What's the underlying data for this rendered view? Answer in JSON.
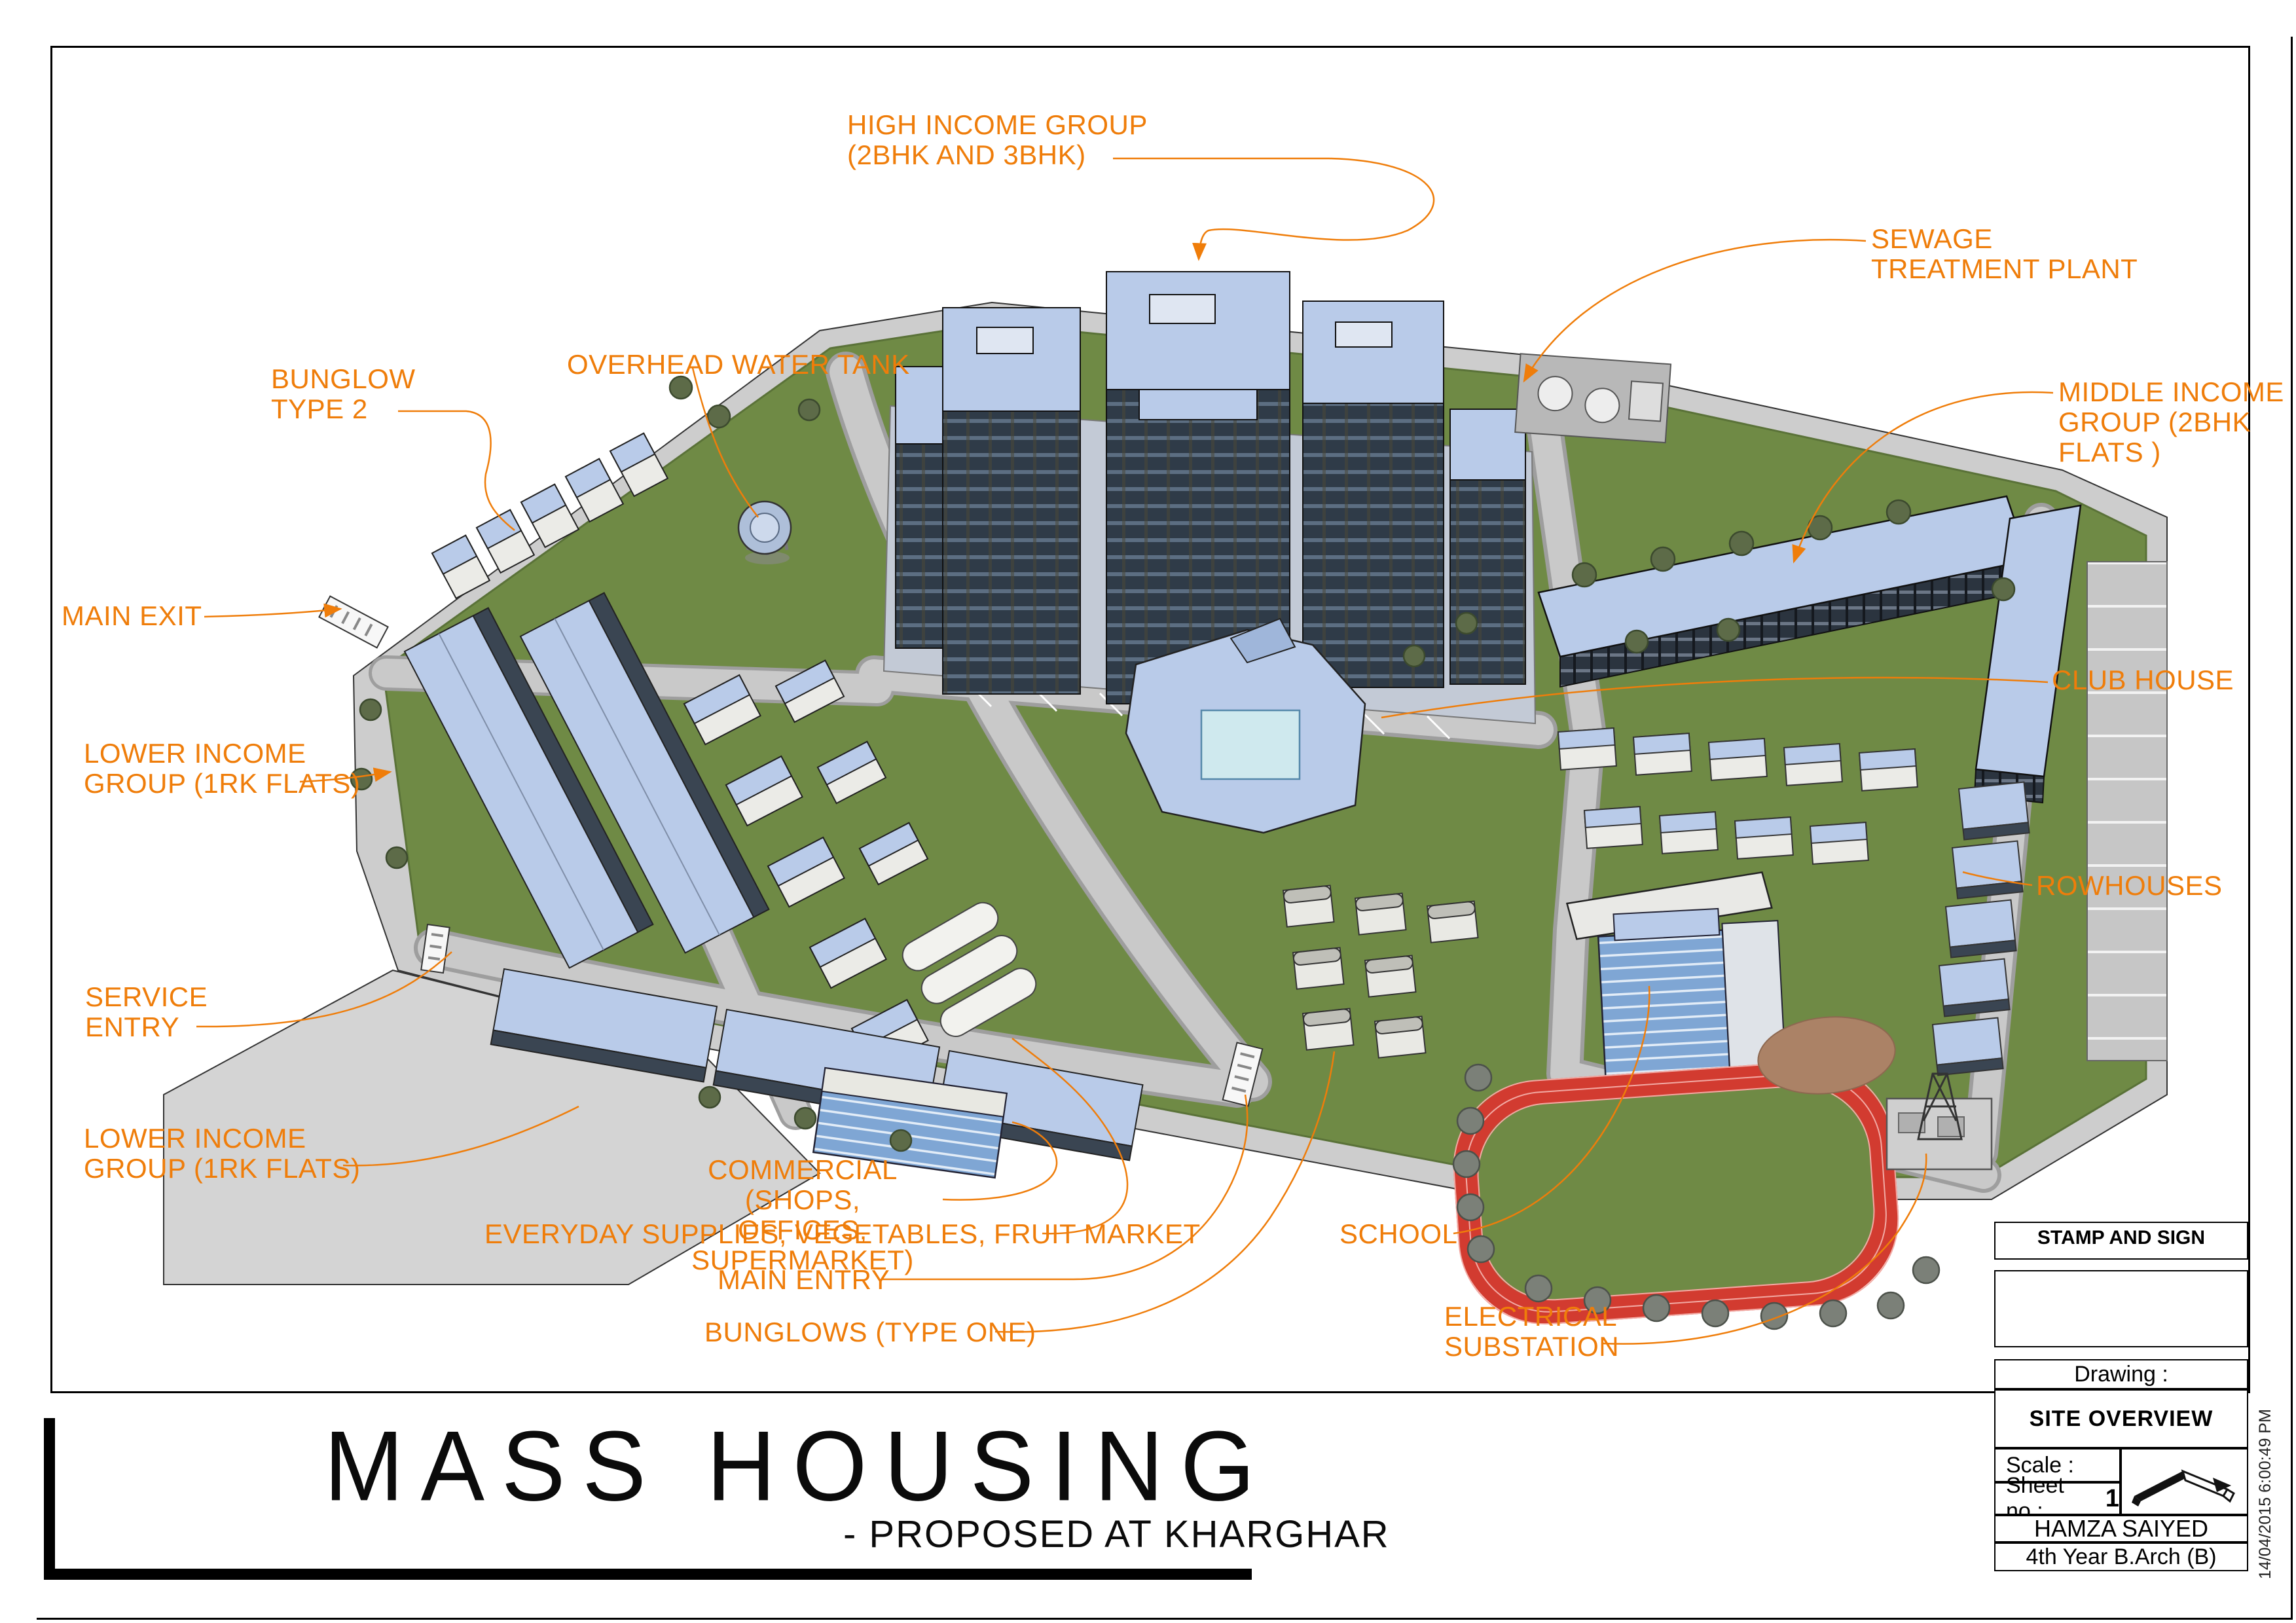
{
  "labels": {
    "high_income": {
      "lines": [
        "HIGH INCOME GROUP",
        "(2BHK AND 3BHK)"
      ]
    },
    "sewage": {
      "lines": [
        "SEWAGE",
        "TREATMENT PLANT"
      ]
    },
    "water_tank": {
      "lines": [
        "OVERHEAD WATER TANK"
      ]
    },
    "bunglow_type2": {
      "lines": [
        "BUNGLOW",
        "TYPE 2"
      ]
    },
    "middle_income": {
      "lines": [
        "MIDDLE INCOME",
        "GROUP (2BHK",
        "FLATS )"
      ]
    },
    "main_exit": {
      "lines": [
        "MAIN EXIT"
      ]
    },
    "lower_income_a": {
      "lines": [
        "LOWER INCOME",
        "GROUP (1RK FLATS)"
      ]
    },
    "club_house": {
      "lines": [
        "CLUB HOUSE"
      ]
    },
    "rowhouses": {
      "lines": [
        "ROWHOUSES"
      ]
    },
    "service_entry": {
      "lines": [
        "SERVICE",
        "ENTRY"
      ]
    },
    "lower_income_b": {
      "lines": [
        "LOWER INCOME",
        "GROUP (1RK FLATS)"
      ]
    },
    "commercial": {
      "lines": [
        "COMMERCIAL (SHOPS,",
        "OFFICES, SUPERMARKET)"
      ]
    },
    "everyday": {
      "lines": [
        "EVERYDAY SUPPLIES, VEGETABLES, FRUIT MARKET"
      ]
    },
    "main_entry": {
      "lines": [
        "MAIN ENTRY"
      ]
    },
    "bunglows_one": {
      "lines": [
        "BUNGLOWS (TYPE ONE)"
      ]
    },
    "school": {
      "lines": [
        "SCHOOL"
      ]
    },
    "electrical": {
      "lines": [
        "ELECTRICAL",
        "SUBSTATION"
      ]
    }
  },
  "title": {
    "main": "MASS HOUSING",
    "subtitle": "- PROPOSED AT KHARGHAR"
  },
  "title_block": {
    "stamp": "STAMP AND SIGN",
    "drawing_label": "Drawing :",
    "drawing_name": "SITE OVERVIEW",
    "scale_label": "Scale :",
    "sheet_label": "Sheet no :",
    "sheet_number": "1",
    "author": "HAMZA SAIYED",
    "class_year": "4th Year B.Arch (B)"
  },
  "timestamp": "14/04/2015 6:00:49 PM",
  "colors": {
    "accent_orange": "#EF7D0A",
    "roof_blue": "#B9CBE9",
    "grass_green": "#6F8A45",
    "road_gray": "#C9C9C9",
    "track_red": "#D23B30",
    "facade_dark": "#2F3B48",
    "dirt_brown": "#AB8266",
    "bus_yellow": "#F0D01C"
  }
}
